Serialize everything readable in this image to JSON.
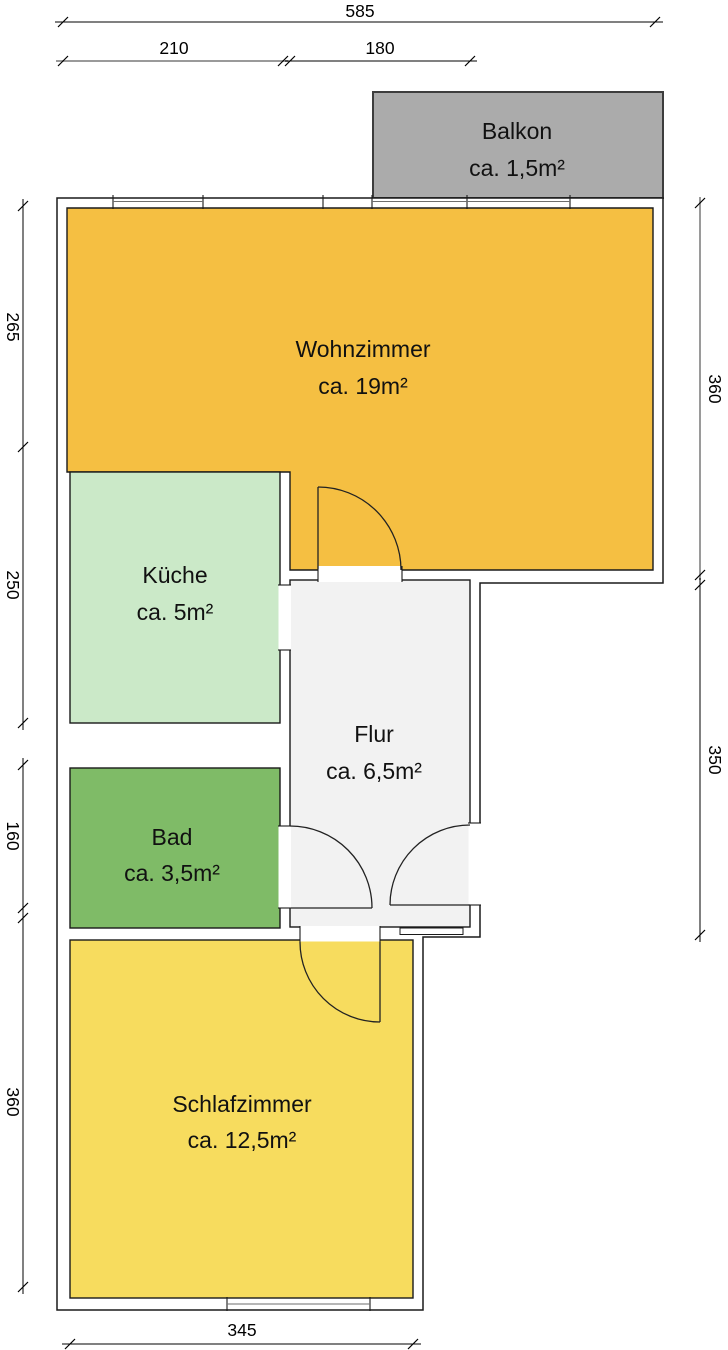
{
  "plan": {
    "title": "apartment-floor-plan",
    "rooms": [
      {
        "id": "balkon",
        "name": "Balkon",
        "area": "ca. 1,5m²",
        "color": "#ababab"
      },
      {
        "id": "wohnzimmer",
        "name": "Wohnzimmer",
        "area": "ca. 19m²",
        "color": "#f5bf42"
      },
      {
        "id": "kueche",
        "name": "Küche",
        "area": "ca. 5m²",
        "color": "#cbe9c8"
      },
      {
        "id": "flur",
        "name": "Flur",
        "area": "ca. 6,5m²",
        "color": "#f2f2f2"
      },
      {
        "id": "bad",
        "name": "Bad",
        "area": "ca. 3,5m²",
        "color": "#7fbb67"
      },
      {
        "id": "schlafzimmer",
        "name": "Schlafzimmer",
        "area": "ca. 12,5m²",
        "color": "#f7dc5e"
      }
    ],
    "dimensions": {
      "top_total": "585",
      "top_segment_left": "210",
      "top_segment_right": "180",
      "left_wohnzimmer": "265",
      "left_kueche": "250",
      "left_bad": "160",
      "left_schlafzimmer": "360",
      "right_upper": "360",
      "right_lower": "350",
      "bottom_schlafzimmer": "345"
    },
    "colors": {
      "wall_line": "#1a1a1a",
      "dim_line": "#000000",
      "dim_gray_line": "#9a9a9a",
      "balcony_border": "#3d3d3d",
      "background": "#ffffff"
    }
  }
}
